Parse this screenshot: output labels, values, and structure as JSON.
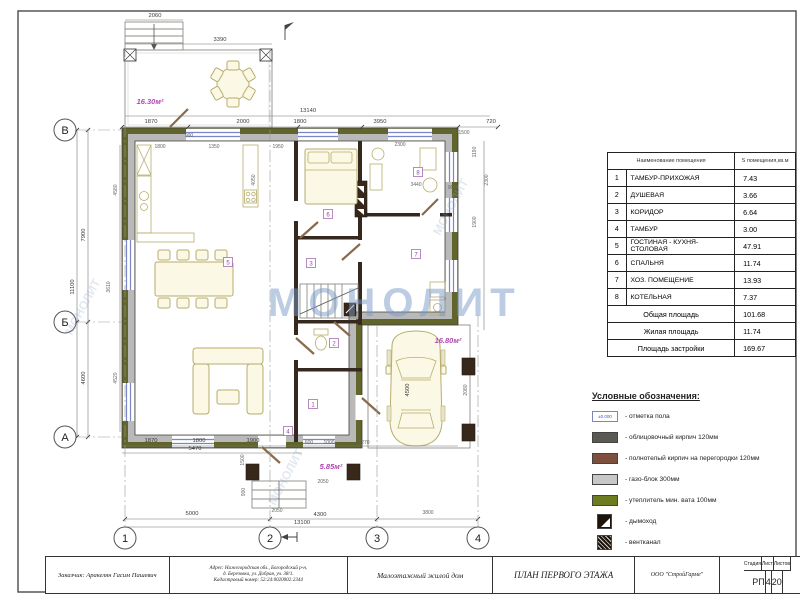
{
  "watermark": {
    "text": "МОНОЛИТ"
  },
  "room_table": {
    "header_name": "Наименование помещения",
    "header_area": "S помещения,кв.м",
    "rows": [
      [
        "1",
        "ТАМБУР-ПРИХОЖАЯ",
        "7.43"
      ],
      [
        "2",
        "ДУШЕВАЯ",
        "3.66"
      ],
      [
        "3",
        "КОРИДОР",
        "6.64"
      ],
      [
        "4",
        "ТАМБУР",
        "3.00"
      ],
      [
        "5",
        "ГОСТИНАЯ - КУХНЯ-СТОЛОВАЯ",
        "47.91"
      ],
      [
        "6",
        "СПАЛЬНЯ",
        "11.74"
      ],
      [
        "7",
        "ХОЗ. ПОМЕЩЕНИЕ",
        "13.93"
      ],
      [
        "8",
        "КОТЕЛЬНАЯ",
        "7.37"
      ]
    ],
    "totals": [
      [
        "Общая площадь",
        "101.68"
      ],
      [
        "Жилая площадь",
        "11.74"
      ],
      [
        "Площадь застройки",
        "169.67"
      ]
    ]
  },
  "legend": {
    "title": "Условные обозначения:",
    "items": [
      {
        "type": "elev",
        "mark": "±0.000",
        "label": "- отметка пола"
      },
      {
        "type": "color",
        "color": "#5a5a52",
        "label": "- облицовочный кирпич 120мм"
      },
      {
        "type": "color",
        "color": "#7d4f3c",
        "label": "- полнотелый кирпич на перегородки 120мм"
      },
      {
        "type": "color",
        "color": "#c7c7c7",
        "label": "- газо-блок 300мм"
      },
      {
        "type": "color",
        "color": "#6d7c1f",
        "label": "- утеплитель мин. вата 100мм"
      },
      {
        "type": "chimney",
        "label": "- дымоход"
      },
      {
        "type": "vent",
        "label": "- вентканал"
      }
    ]
  },
  "title_block": {
    "client": "Заказчик: Аракелян Гасим Пашевич",
    "address_lines": [
      "Адрес:  Нижегородская обл., Богородский р-н,",
      "д. Березовка, ул. Добрая, уч. 38/1.",
      "Кадастровый номер:  52:24:0020002:2344"
    ],
    "object": "Малоэтажный жилой дом",
    "drawing_title": "ПЛАН ПЕРВОГО ЭТАЖА",
    "company": "ООО \"СтройГарме\"",
    "stage_label": "Стадия",
    "sheet_label": "Лист",
    "sheets_label": "Листов",
    "stage": "РП",
    "sheet_no": "4",
    "sheets_total": "20"
  },
  "plan": {
    "axes_rows": [
      {
        "label": "В",
        "y": 130
      },
      {
        "label": "Б",
        "y": 322
      },
      {
        "label": "А",
        "y": 437
      }
    ],
    "axes_cols": [
      {
        "label": "1",
        "x": 125,
        "top": 45
      },
      {
        "label": "2",
        "x": 270,
        "top": 50
      },
      {
        "label": "3",
        "x": 377,
        "top": 325
      },
      {
        "label": "4",
        "x": 478,
        "top": 315
      }
    ],
    "areas": [
      {
        "t": "16.30м²",
        "x": 150,
        "y": 104
      },
      {
        "t": "16.80м²",
        "x": 448,
        "y": 343
      },
      {
        "t": "5.85м²",
        "x": 331,
        "y": 469
      }
    ],
    "rooms": [
      {
        "n": "1",
        "x": 313,
        "y": 404
      },
      {
        "n": "2",
        "x": 334,
        "y": 343
      },
      {
        "n": "3",
        "x": 311,
        "y": 263
      },
      {
        "n": "4",
        "x": 288,
        "y": 431
      },
      {
        "n": "5",
        "x": 228,
        "y": 262
      },
      {
        "n": "6",
        "x": 328,
        "y": 214
      },
      {
        "n": "7",
        "x": 416,
        "y": 254
      },
      {
        "n": "8",
        "x": 418,
        "y": 172
      }
    ],
    "dims": [
      {
        "t": "2060",
        "x": 155,
        "y": 17
      },
      {
        "t": "3390",
        "x": 220,
        "y": 41
      },
      {
        "t": "13140",
        "x": 308,
        "y": 112
      },
      {
        "t": "1870",
        "x": 151,
        "y": 123
      },
      {
        "t": "2000",
        "x": 243,
        "y": 123
      },
      {
        "t": "1800",
        "x": 300,
        "y": 123
      },
      {
        "t": "3950",
        "x": 380,
        "y": 123
      },
      {
        "t": "720",
        "x": 491,
        "y": 123
      },
      {
        "t": "900",
        "x": 189,
        "y": 137,
        "s": true
      },
      {
        "t": "1500",
        "x": 464,
        "y": 134,
        "s": true
      },
      {
        "t": "1800",
        "x": 160,
        "y": 148,
        "s": true
      },
      {
        "t": "1350",
        "x": 214,
        "y": 148,
        "s": true
      },
      {
        "t": "1950",
        "x": 278,
        "y": 148,
        "s": true
      },
      {
        "t": "2300",
        "x": 400,
        "y": 146,
        "s": true
      },
      {
        "t": "3440",
        "x": 416,
        "y": 186,
        "s": true
      },
      {
        "t": "900",
        "x": 452,
        "y": 189,
        "s": true
      },
      {
        "t": "4050",
        "x": 255,
        "y": 180,
        "r": -90,
        "s": true
      },
      {
        "t": "7900",
        "x": 85,
        "y": 235,
        "r": -90
      },
      {
        "t": "11100",
        "x": 74,
        "y": 287,
        "r": -90
      },
      {
        "t": "4600",
        "x": 85,
        "y": 378,
        "r": -90
      },
      {
        "t": "4580",
        "x": 117,
        "y": 190,
        "r": -90,
        "s": true
      },
      {
        "t": "3610",
        "x": 110,
        "y": 287,
        "r": -90,
        "s": true
      },
      {
        "t": "4520",
        "x": 117,
        "y": 378,
        "r": -90,
        "s": true
      },
      {
        "t": "2300",
        "x": 488,
        "y": 180,
        "r": -90,
        "s": true
      },
      {
        "t": "1190",
        "x": 476,
        "y": 152,
        "r": -90,
        "s": true
      },
      {
        "t": "1900",
        "x": 476,
        "y": 222,
        "r": -90,
        "s": true
      },
      {
        "t": "2080",
        "x": 467,
        "y": 390,
        "r": -90,
        "s": true
      },
      {
        "t": "1870",
        "x": 151,
        "y": 442
      },
      {
        "t": "1800",
        "x": 199,
        "y": 442
      },
      {
        "t": "1900",
        "x": 253,
        "y": 442
      },
      {
        "t": "5470",
        "x": 195,
        "y": 450
      },
      {
        "t": "600",
        "x": 309,
        "y": 444,
        "s": true
      },
      {
        "t": "1000",
        "x": 329,
        "y": 444,
        "s": true
      },
      {
        "t": "5270",
        "x": 364,
        "y": 444,
        "s": true
      },
      {
        "t": "1500",
        "x": 244,
        "y": 460,
        "r": -90,
        "s": true
      },
      {
        "t": "900",
        "x": 245,
        "y": 492,
        "r": -90,
        "s": true
      },
      {
        "t": "2050",
        "x": 323,
        "y": 483,
        "s": true
      },
      {
        "t": "2050",
        "x": 277,
        "y": 512,
        "s": true
      },
      {
        "t": "5000",
        "x": 192,
        "y": 515
      },
      {
        "t": "4300",
        "x": 320,
        "y": 516
      },
      {
        "t": "13100",
        "x": 302,
        "y": 524
      },
      {
        "t": "3800",
        "x": 428,
        "y": 514,
        "s": true
      },
      {
        "t": "4500",
        "x": 409,
        "y": 390,
        "r": -90,
        "c": "#c04040"
      }
    ]
  }
}
